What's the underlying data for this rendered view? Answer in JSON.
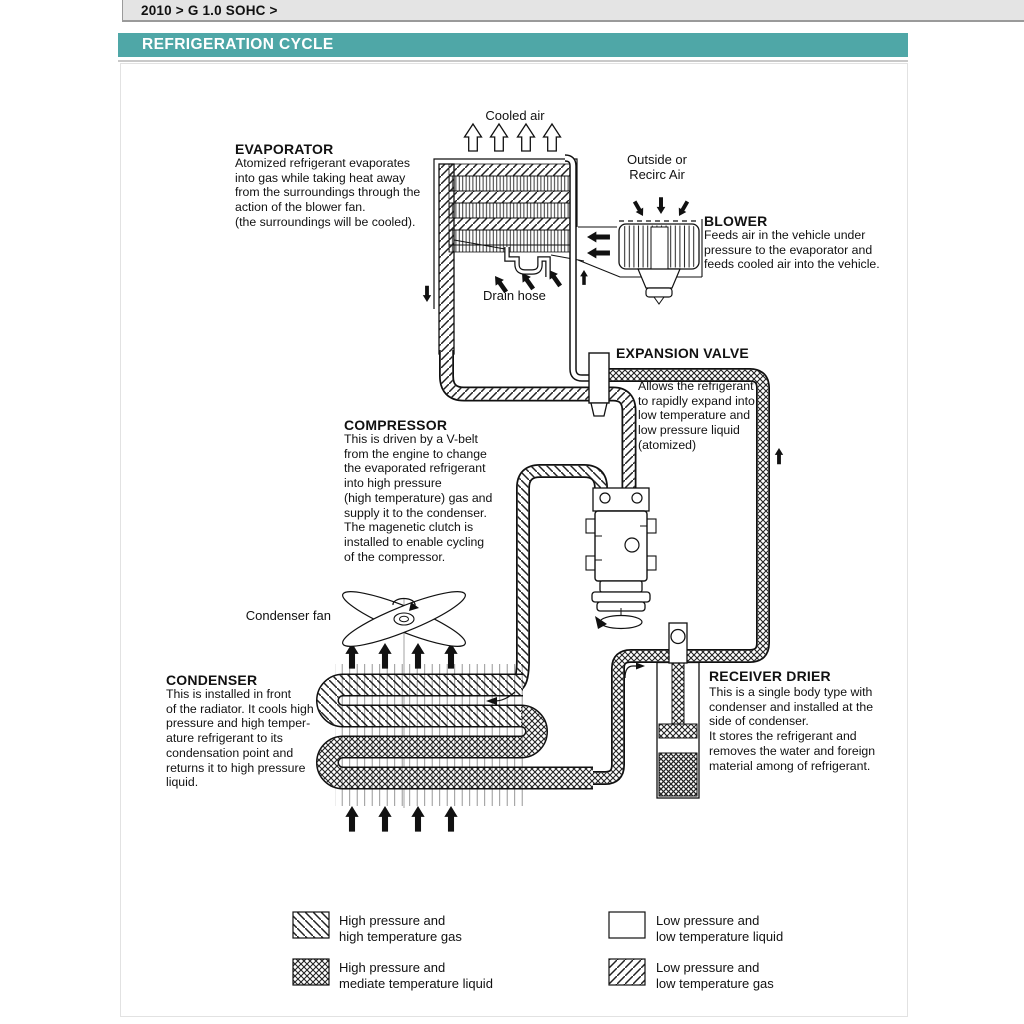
{
  "page": {
    "breadcrumb": "2010 > G 1.0 SOHC >",
    "title": "REFRIGERATION CYCLE",
    "colors": {
      "accent_teal": "#4FA7A7",
      "breadcrumb_bg": "#E4E4E4",
      "line": "#111111"
    }
  },
  "diagram": {
    "labels": {
      "cooled_air": "Cooled air",
      "outside_air": "Outside or\nRecirc Air",
      "drain_hose": "Drain hose",
      "condenser_fan": "Condenser fan"
    },
    "components": {
      "evaporator": {
        "name": "EVAPORATOR",
        "description": "Atomized refrigerant evaporates\ninto gas while taking heat away\nfrom the surroundings through the\naction of the blower fan.\n(the surroundings will be cooled)."
      },
      "blower": {
        "name": "BLOWER",
        "description": "Feeds air in the vehicle under\npressure to the evaporator and\nfeeds cooled air into the vehicle."
      },
      "expansion_valve": {
        "name": "EXPANSION VALVE",
        "description": "Allows the refrigerant\nto rapidly expand into\nlow temperature and\nlow pressure liquid\n(atomized)"
      },
      "compressor": {
        "name": "COMPRESSOR",
        "description": "This is driven by a V-belt\nfrom the engine to change\nthe evaporated refrigerant\ninto high pressure\n(high temperature) gas and\nsupply it to the condenser.\nThe magenetic clutch is\ninstalled to enable cycling\nof the compressor."
      },
      "condenser": {
        "name": "CONDENSER",
        "description": "This is installed in front\nof the radiator. It cools high\npressure and high temper-\nature refrigerant to its\ncondensation point and\nreturns it to high pressure\nliquid."
      },
      "receiver_drier": {
        "name": "RECEIVER DRIER",
        "description": "This is a single body type with\ncondenser and installed at the\nside of condenser.\nIt stores the refrigerant and\nremoves the water and foreign\nmaterial among of refrigerant."
      }
    },
    "legend": {
      "items": [
        {
          "pattern": "diagonal-backslash",
          "label": "High pressure and\nhigh temperature gas"
        },
        {
          "pattern": "crosshatch",
          "label": "High pressure and\nmediate temperature liquid"
        },
        {
          "pattern": "none",
          "label": "Low pressure and\nlow temperature liquid"
        },
        {
          "pattern": "diagonal-slash",
          "label": "Low pressure and\nlow temperature gas"
        }
      ]
    }
  }
}
